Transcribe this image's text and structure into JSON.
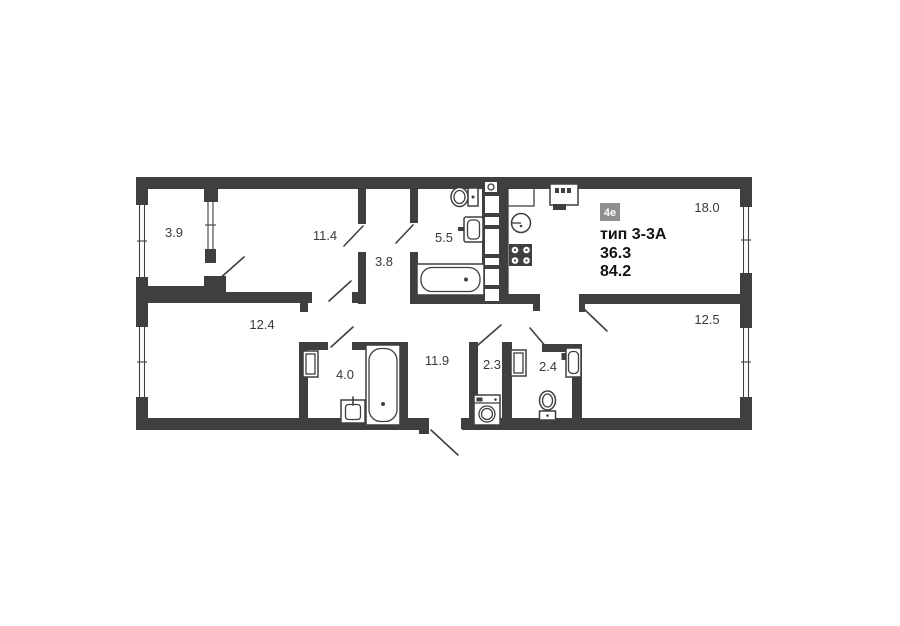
{
  "floor_plan": {
    "unit_badge": "4е",
    "unit_type": "тип 3-3А",
    "living_area": "36.3",
    "total_area": "84.2",
    "rooms": {
      "balcony": "3.9",
      "bedroom_top": "11.4",
      "inner_hall": "3.8",
      "bathroom_main": "5.5",
      "living_room": "18.0",
      "bedroom_left": "12.4",
      "bathroom_small": "4.0",
      "corridor": "11.9",
      "laundry": "2.3",
      "wc": "2.4",
      "bedroom_right": "12.5"
    },
    "colors": {
      "wall": "#3f3f3f",
      "floor": "#ffffff",
      "badge_bg": "#909090",
      "badge_text": "#ffffff",
      "label_text": "#3a3a3a"
    }
  }
}
